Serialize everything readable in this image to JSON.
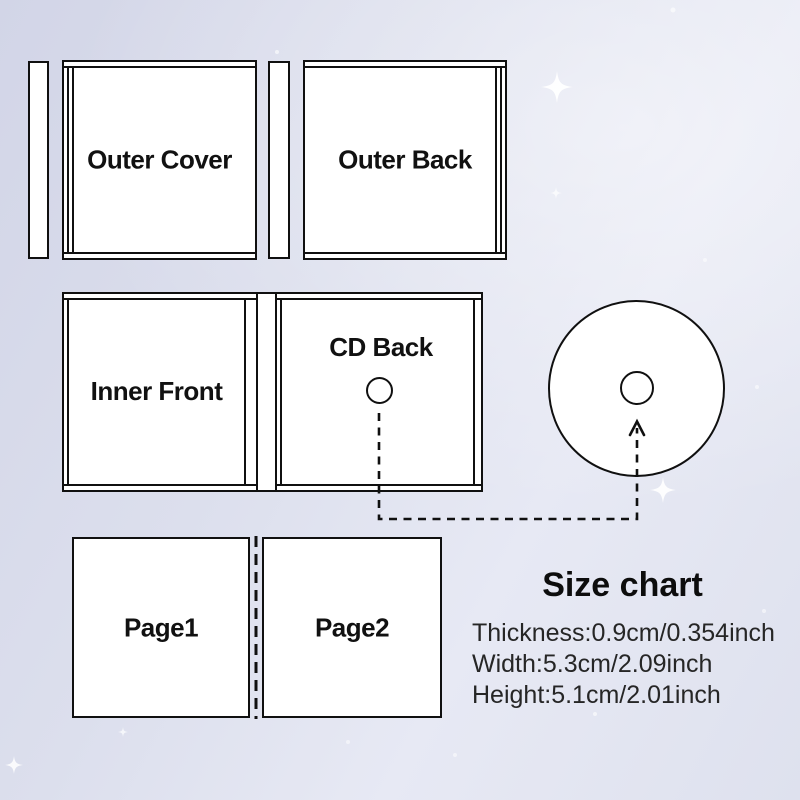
{
  "diagram": {
    "outer_cover": "Outer Cover",
    "outer_back": "Outer Back",
    "inner_front": "Inner Front",
    "cd_back": "CD Back",
    "page1": "Page1",
    "page2": "Page2"
  },
  "size_chart": {
    "title": "Size chart",
    "rows": [
      "Thickness:0.9cm/0.354inch",
      "Width:5.3cm/2.09inch",
      "Height:5.1cm/2.01inch"
    ]
  },
  "colors": {
    "line": "#101010",
    "panel_fill": "#ffffff",
    "text": "#1c1c1c",
    "background_top_left": "#d2d5e7",
    "background_center": "#e7e9f4",
    "background_bottom": "#dee1ee"
  }
}
